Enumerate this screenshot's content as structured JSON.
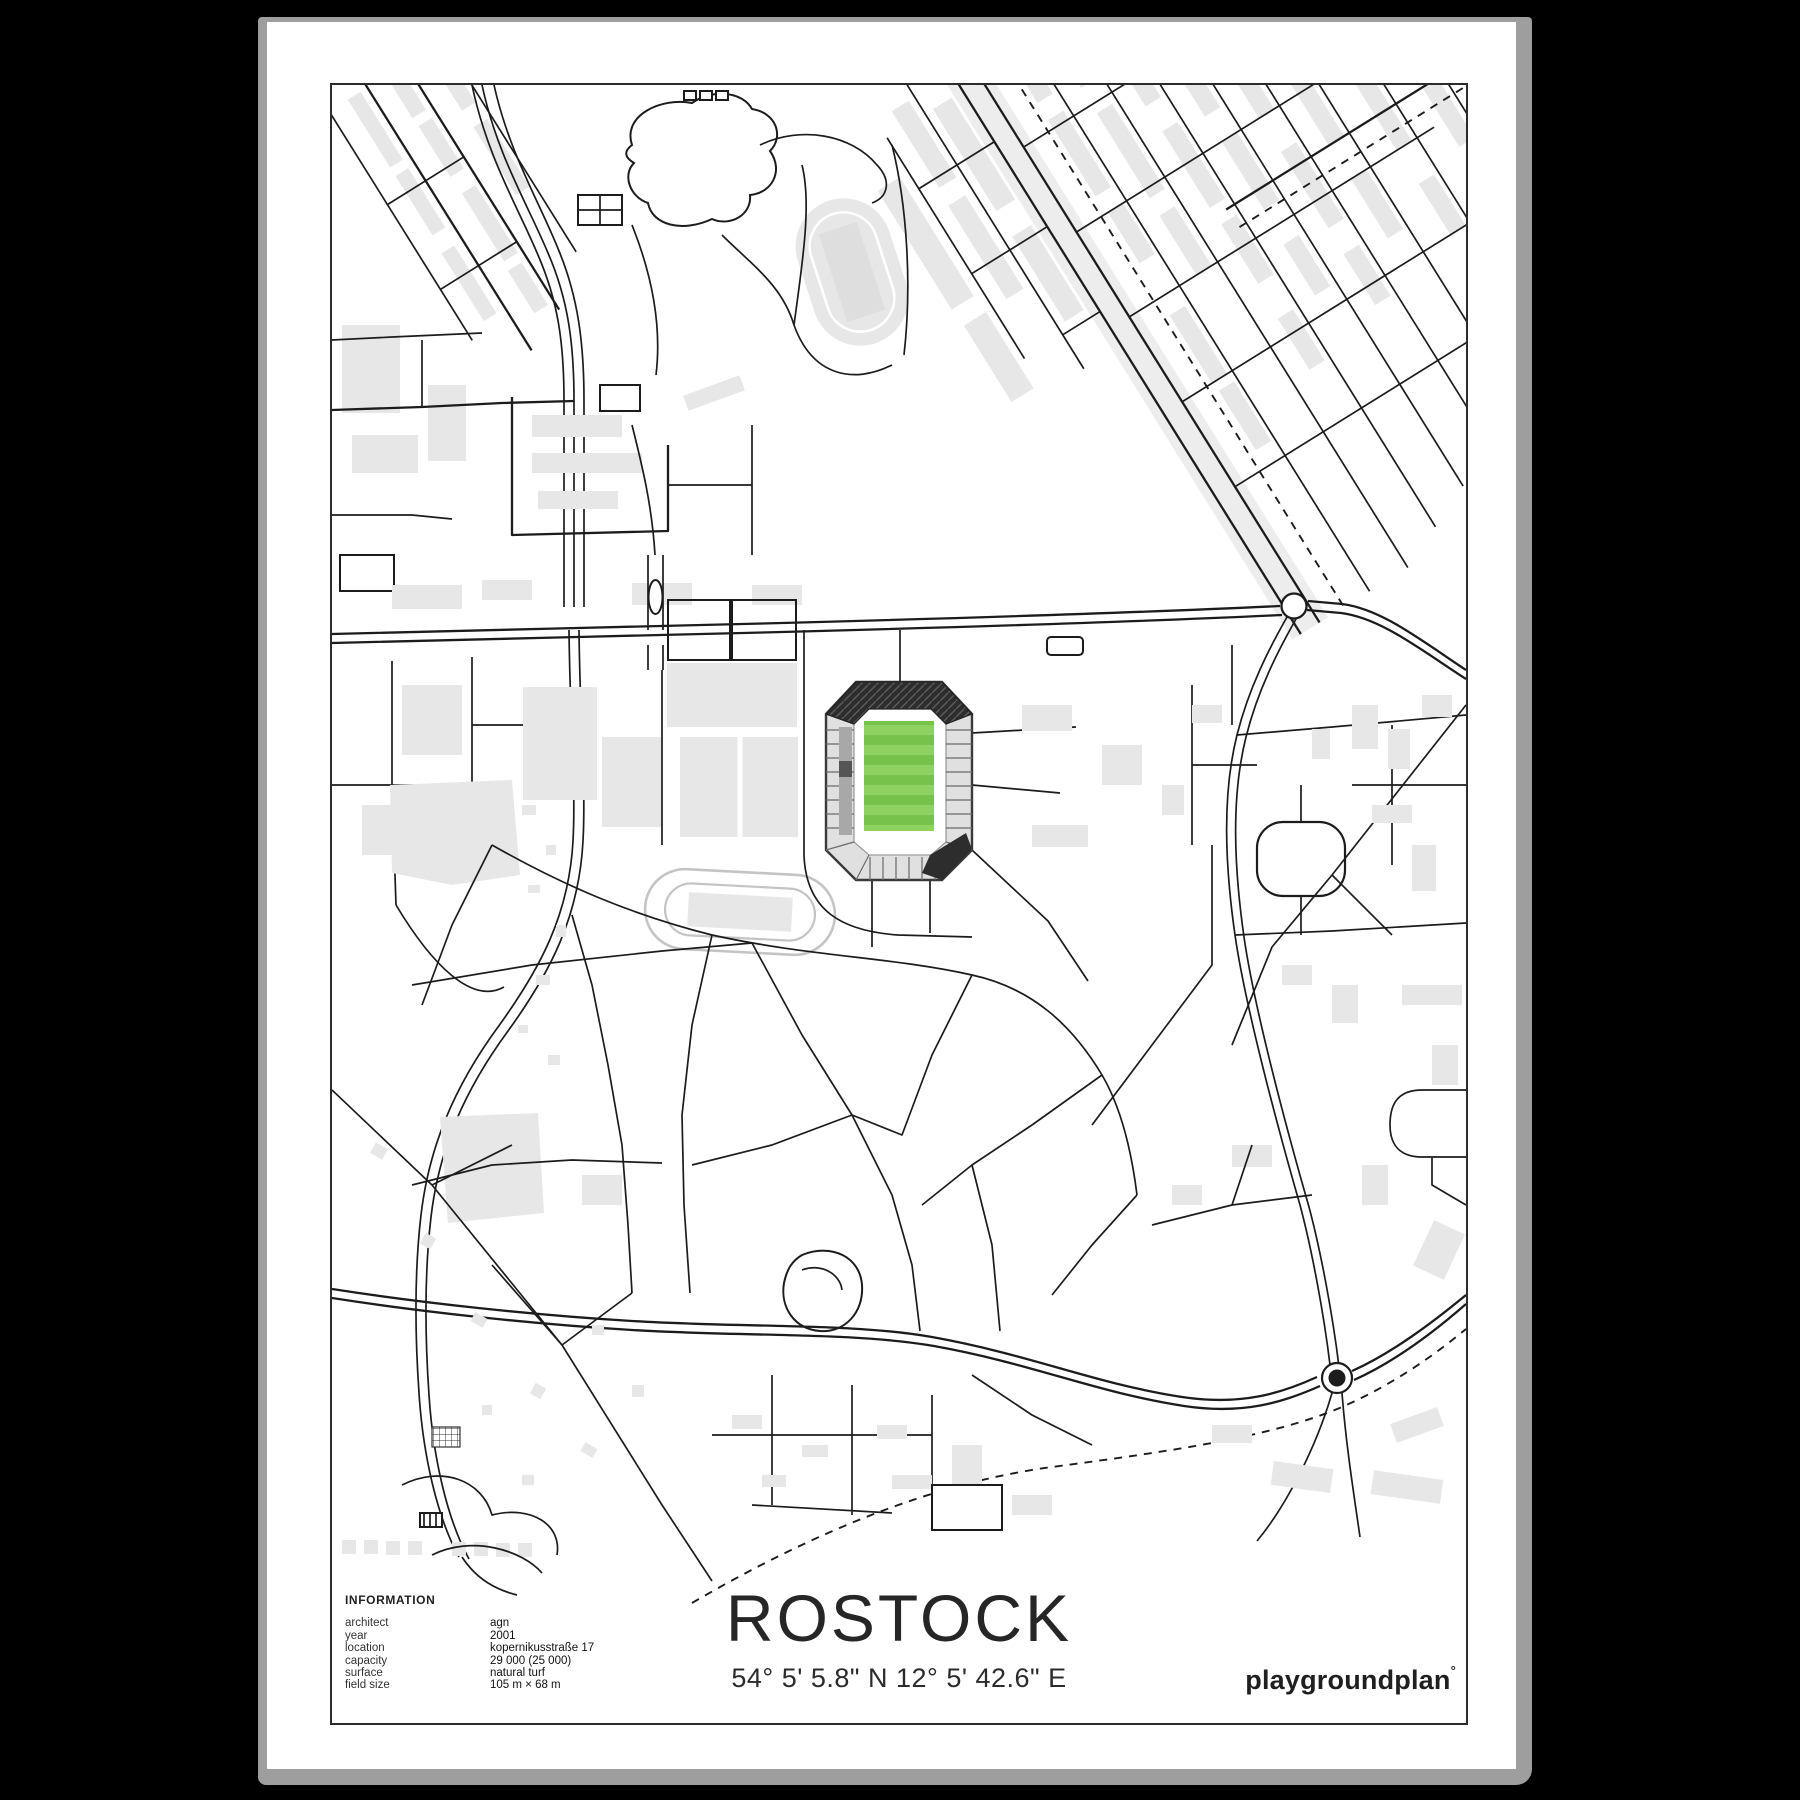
{
  "poster": {
    "title": "ROSTOCK",
    "coordinates": "54° 5' 5.8\" N  12° 5' 42.6\" E",
    "brand": {
      "name": "playgroundplan",
      "mark": "°"
    },
    "information": {
      "heading": "INFORMATION",
      "rows": [
        {
          "label": "architect",
          "value": "agn"
        },
        {
          "label": "year",
          "value": "2001"
        },
        {
          "label": "location",
          "value": "kopernikusstraße 17"
        },
        {
          "label": "capacity",
          "value": "29 000 (25 000)"
        },
        {
          "label": "surface",
          "value": "natural turf"
        },
        {
          "label": "field size",
          "value": "105 m × 68 m"
        }
      ]
    }
  },
  "map": {
    "stadium_icon": "stadium-with-green-pitch",
    "features": [
      "streets",
      "buildings",
      "railway-dashed",
      "roundabouts",
      "park-paths",
      "athletics-tracks",
      "ponds"
    ]
  },
  "colors": {
    "background": "#000000",
    "frame": "#9e9e9e",
    "paper": "#ffffff",
    "map_border": "#2b2b2b",
    "road": "#1c1c1c",
    "building": "#e7e7e7",
    "verge": "#ededed",
    "pitch_light": "#8ed262",
    "pitch_dark": "#77c24b",
    "stand": "#e0e0e0",
    "stand_dark": "#a8a8a8",
    "roof": "#2d2d2d",
    "track_gray": "#c4c4c4",
    "text": "#1d1d1d"
  }
}
